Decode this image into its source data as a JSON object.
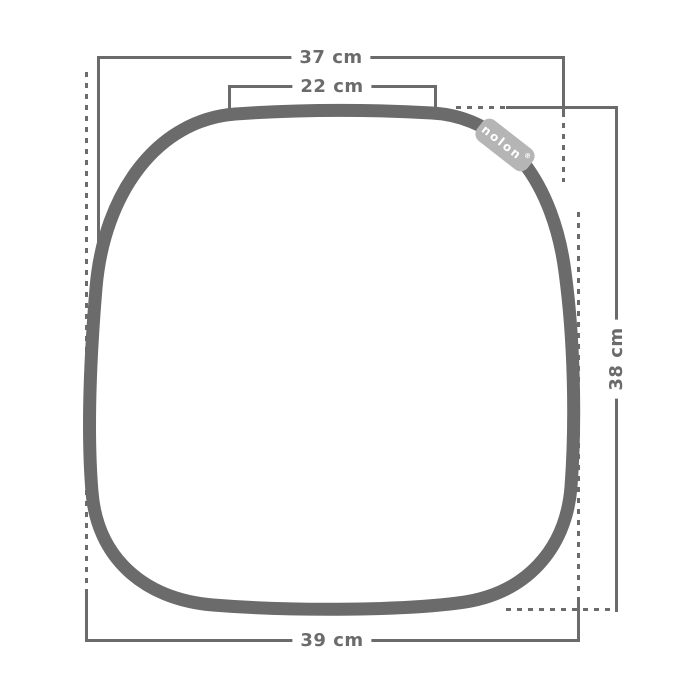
{
  "colors": {
    "line": "#6b6b6b",
    "tag_fill": "#b5b5b5",
    "tag_text": "#ffffff",
    "background": "#ffffff"
  },
  "product": {
    "brand_tag": {
      "label": "nolon",
      "registered": "®"
    }
  },
  "dimensions": {
    "top_width": "37 cm",
    "top_flat_width": "22 cm",
    "bottom_width": "39 cm",
    "side_height": "38 cm"
  }
}
